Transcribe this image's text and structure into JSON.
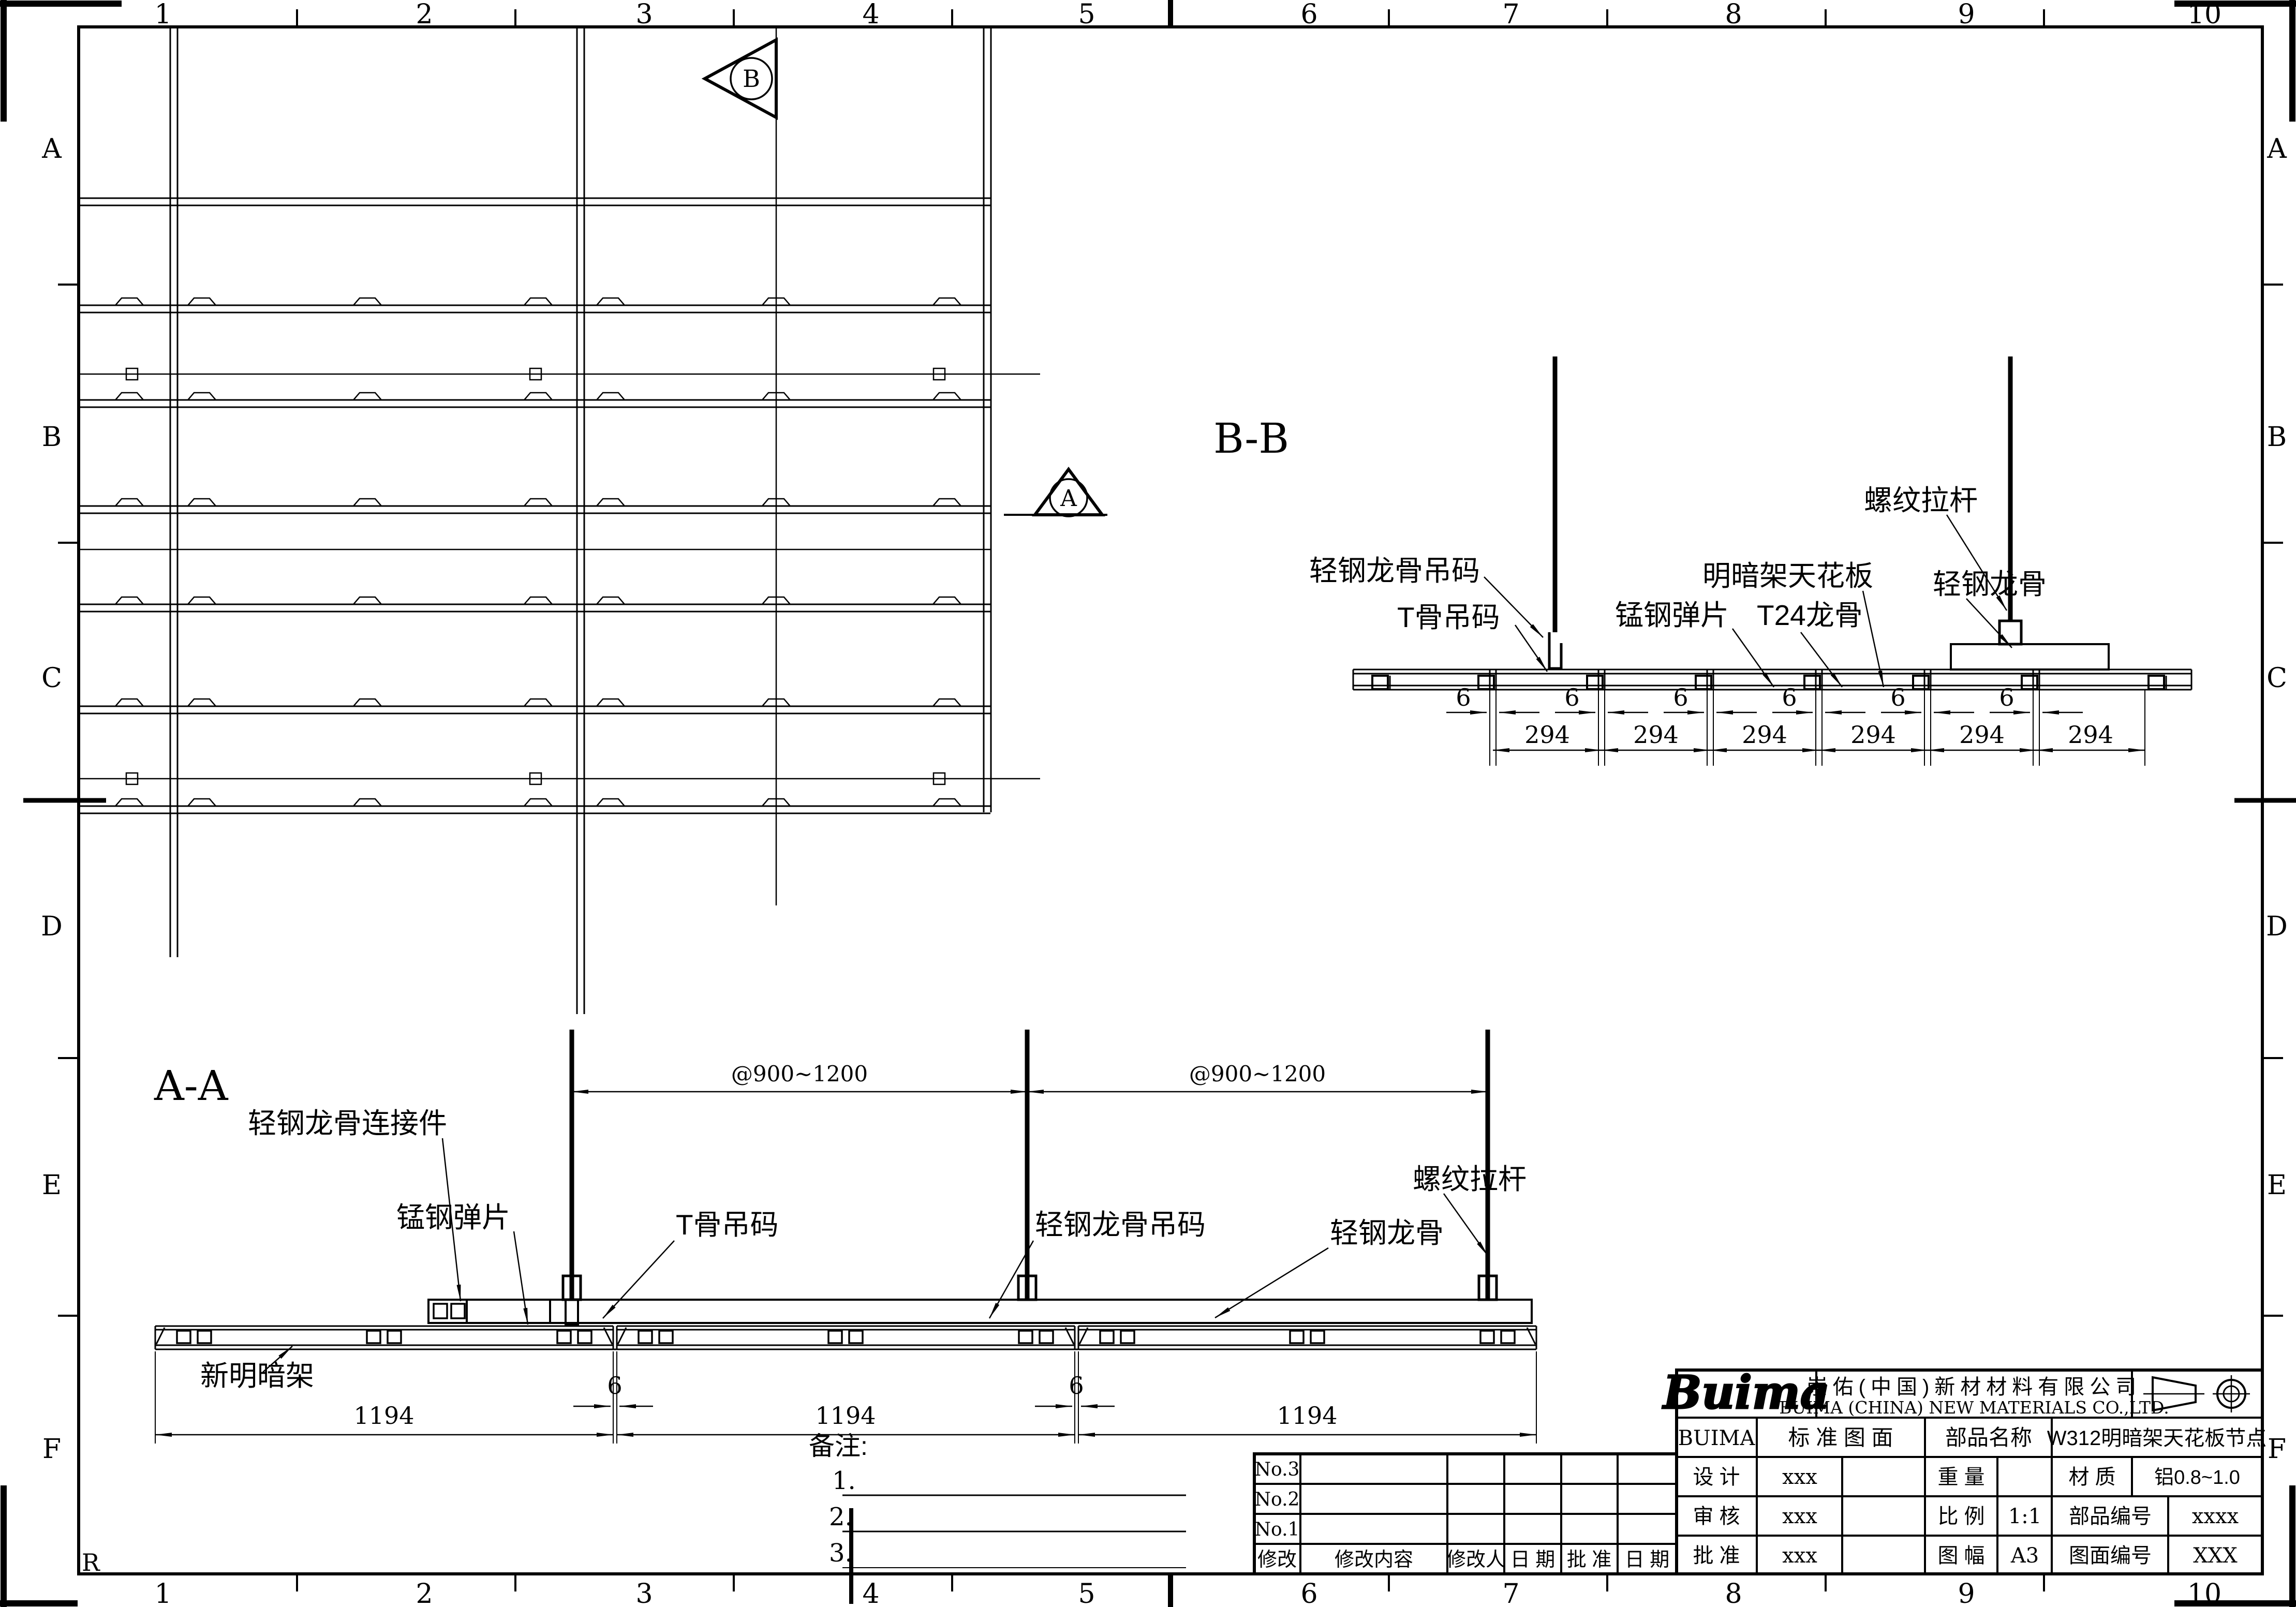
{
  "sheet": {
    "cols": [
      "1",
      "2",
      "3",
      "4",
      "5",
      "6",
      "7",
      "8",
      "9",
      "10"
    ],
    "rows": [
      "A",
      "B",
      "C",
      "D",
      "E",
      "F"
    ]
  },
  "markers": {
    "a": "A",
    "b": "B"
  },
  "misc": {
    "corner_r": "R"
  },
  "bb": {
    "title": "B-B",
    "dim_gap": "6",
    "dim_panel": "294",
    "labels": {
      "keel_hanger": "轻钢龙骨吊码",
      "t_hanger": "T骨吊码",
      "spring": "锰钢弹片",
      "panel": "明暗架天花板",
      "t24": "T24龙骨",
      "keel": "轻钢龙骨",
      "rod": "螺纹拉杆"
    }
  },
  "aa": {
    "title": "A-A",
    "dim_spacing": "@900~1200",
    "dim_panel": "1194",
    "dim_gap": "6",
    "labels": {
      "connector": "轻钢龙骨连接件",
      "spring": "锰钢弹片",
      "t_hanger": "T骨吊码",
      "keel_hanger": "轻钢龙骨吊码",
      "keel": "轻钢龙骨",
      "rod": "螺纹拉杆",
      "new_panel": "新明暗架"
    }
  },
  "notes": {
    "title": "备注:",
    "items": [
      "1.",
      "2.",
      "3."
    ]
  },
  "rev": {
    "rows": [
      "No.3",
      "No.2",
      "No.1"
    ],
    "headers": [
      "修改",
      "修改内容",
      "修改人",
      "日 期",
      "批 准",
      "日 期"
    ]
  },
  "tb": {
    "logo": "Buima",
    "company_cn": "崇佑(中国)新材材料有限公司",
    "company_en": "BUIMA (CHINA) NEW MATERIALS CO.,LTD.",
    "brand": "BUIMA",
    "std": "标 准 图 面",
    "part_name_label": "部品名称",
    "part_name": "W312明暗架天花板节点",
    "design": "设 计",
    "design_v": "xxx",
    "weight": "重 量",
    "material": "材 质",
    "material_v": "铝0.8~1.0",
    "check": "审 核",
    "check_v": "xxx",
    "scale": "比 例",
    "scale_v": "1:1",
    "part_no": "部品编号",
    "part_no_v": "xxxx",
    "approve": "批 准",
    "approve_v": "xxx",
    "size": "图 幅",
    "size_v": "A3",
    "dwg_no": "图面编号",
    "dwg_no_v": "XXX"
  }
}
